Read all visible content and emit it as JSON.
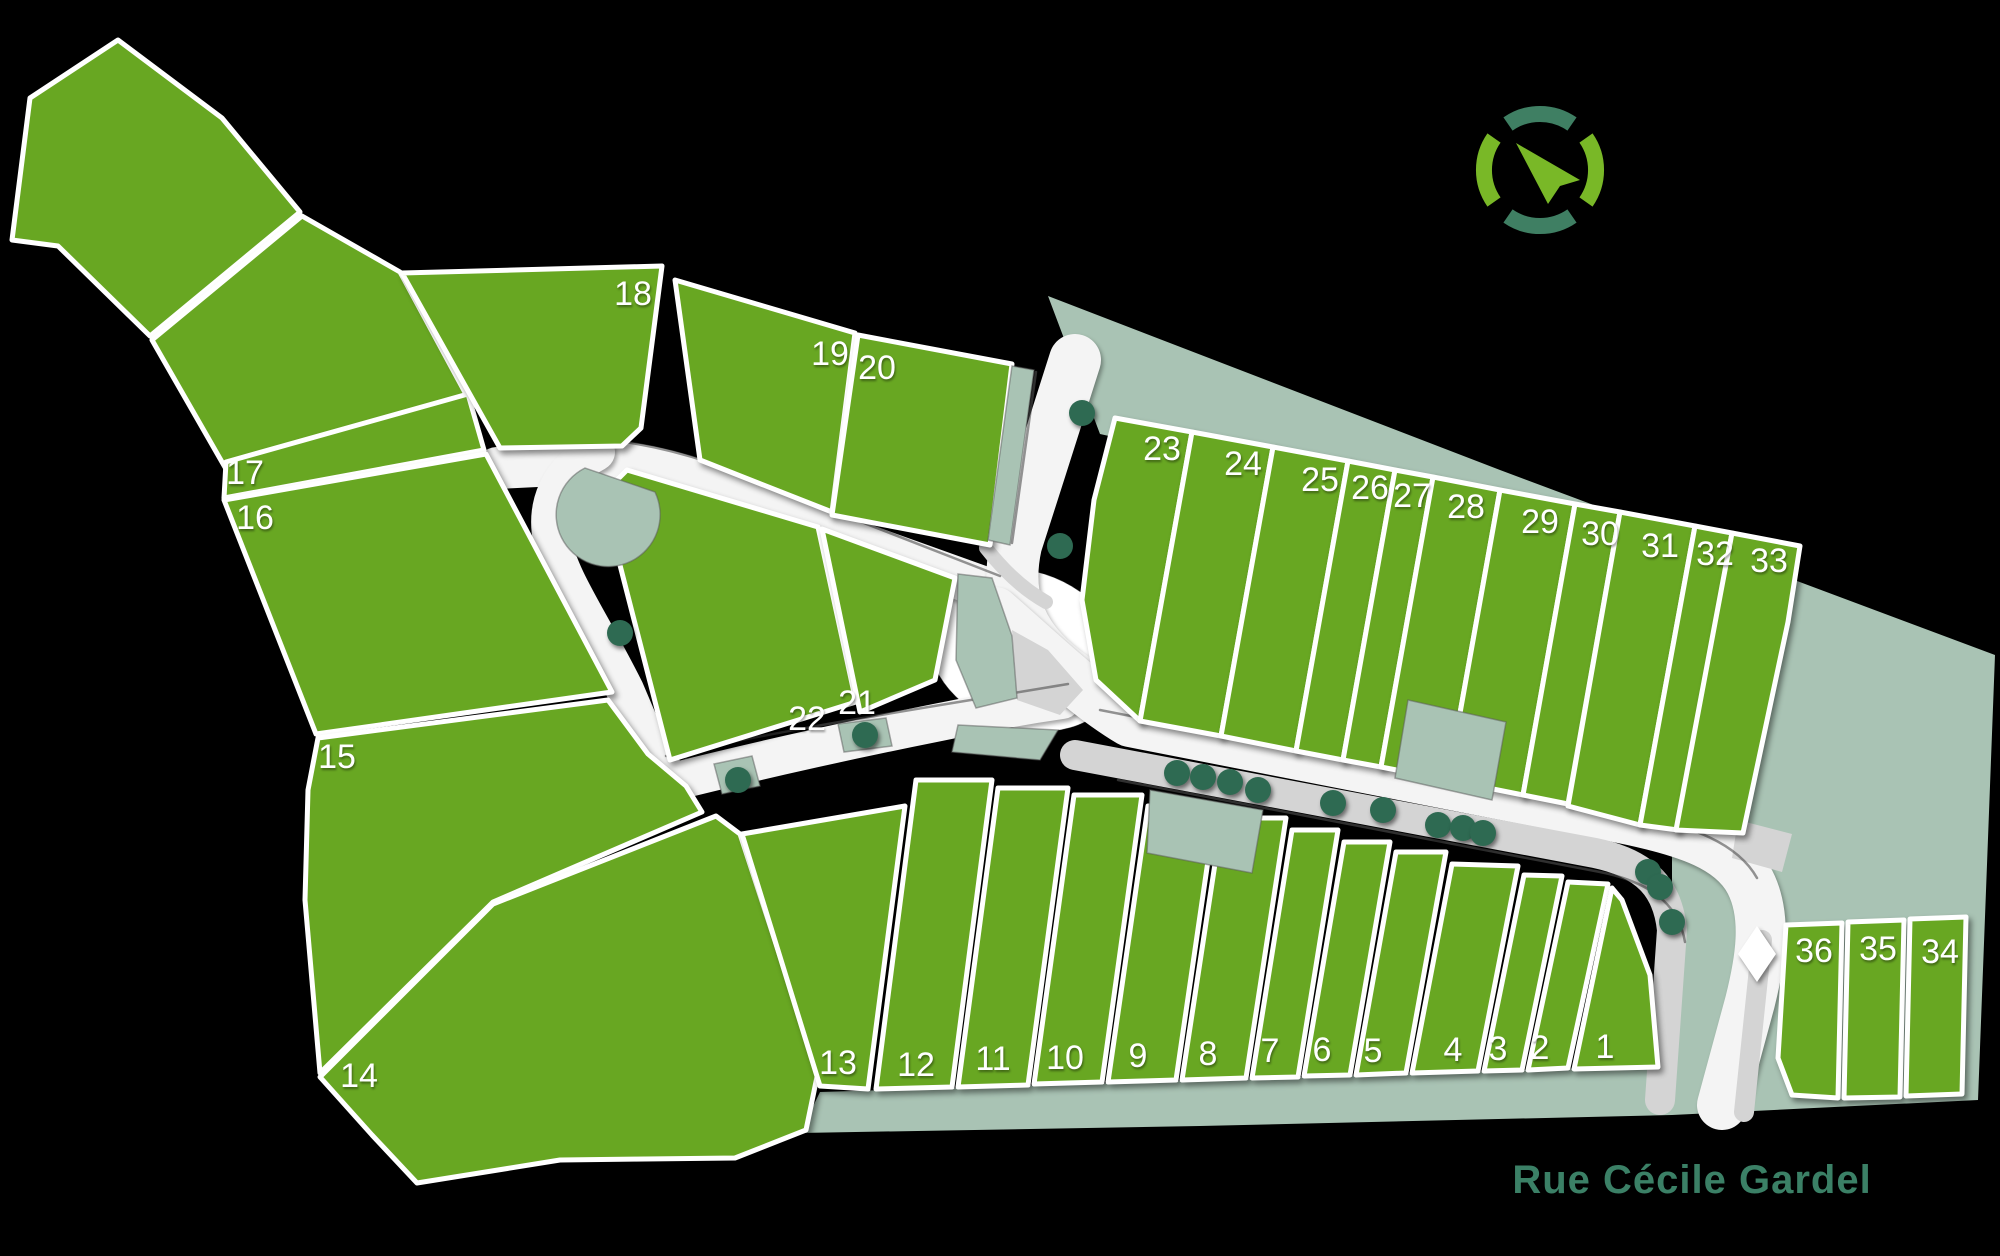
{
  "street": {
    "name": "Rue Cécile Gardel"
  },
  "compass": {
    "icon": "compass-north-pointer-icon"
  },
  "colors": {
    "background": "#000000",
    "parcel_green": "#68a722",
    "landscape_sage": "#a9c3b4",
    "road_white": "#f4f4f4",
    "sidewalk_gray": "#d4d4d4",
    "curb_gray": "#4f4f4f",
    "tree_green": "#2e6a52",
    "compass_teal": "#3f7f63",
    "compass_green": "#79b827",
    "street_text": "#3b8066",
    "label_white": "#ffffff"
  },
  "lots": [
    {
      "label": "1"
    },
    {
      "label": "2"
    },
    {
      "label": "3"
    },
    {
      "label": "4"
    },
    {
      "label": "5"
    },
    {
      "label": "6"
    },
    {
      "label": "7"
    },
    {
      "label": "8"
    },
    {
      "label": "9"
    },
    {
      "label": "10"
    },
    {
      "label": "11"
    },
    {
      "label": "12"
    },
    {
      "label": "13"
    },
    {
      "label": "14"
    },
    {
      "label": "15"
    },
    {
      "label": "16"
    },
    {
      "label": "17"
    },
    {
      "label": "18"
    },
    {
      "label": "19"
    },
    {
      "label": "20"
    },
    {
      "label": "21"
    },
    {
      "label": "22"
    },
    {
      "label": "23"
    },
    {
      "label": "24"
    },
    {
      "label": "25"
    },
    {
      "label": "26"
    },
    {
      "label": "27"
    },
    {
      "label": "28"
    },
    {
      "label": "29"
    },
    {
      "label": "30"
    },
    {
      "label": "31"
    },
    {
      "label": "32"
    },
    {
      "label": "33"
    },
    {
      "label": "34"
    },
    {
      "label": "35"
    },
    {
      "label": "36"
    }
  ]
}
